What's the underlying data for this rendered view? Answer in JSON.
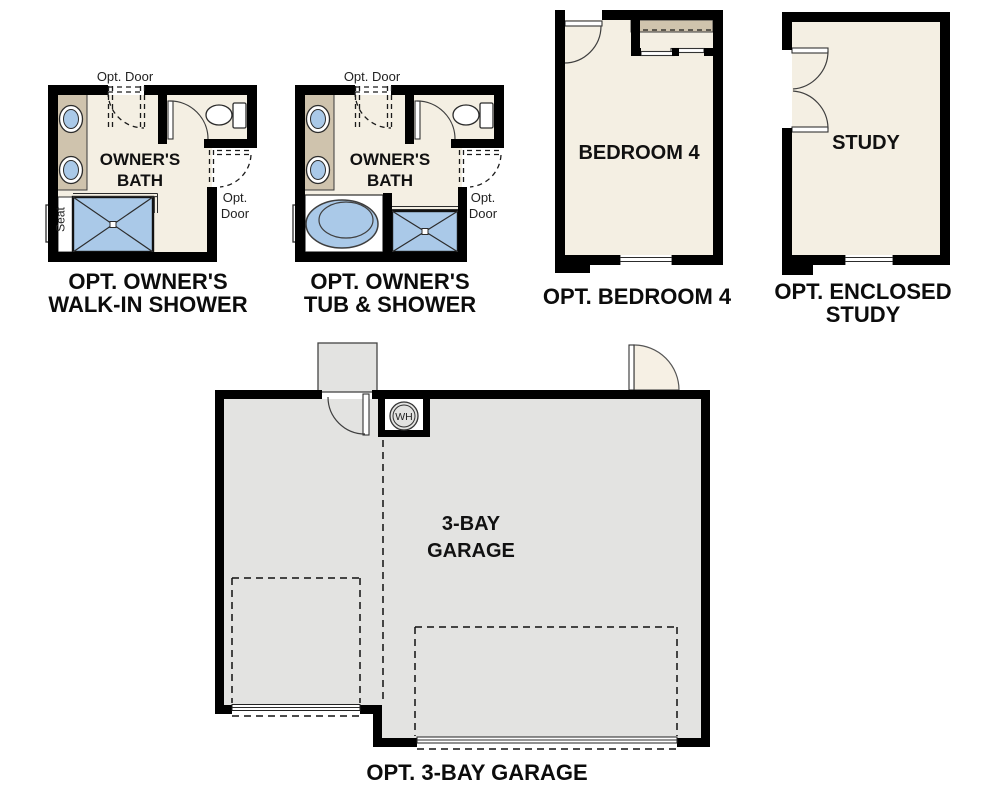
{
  "page": {
    "background": "#ffffff"
  },
  "colors": {
    "wall": "#000000",
    "floor_cream": "#f4efe3",
    "counter_tan": "#cfc3ad",
    "fixture_blue": "#aac9e8",
    "garage_gray": "#e3e3e1",
    "door_swing_cream": "#f6f0e4",
    "text": "#111111"
  },
  "plans": {
    "walk_in_shower": {
      "caption_line1": "OPT. OWNER'S",
      "caption_line2": "WALK-IN SHOWER",
      "room_line1": "OWNER'S",
      "room_line2": "BATH",
      "opt_door_top": "Opt. Door",
      "opt_door_right_line1": "Opt.",
      "opt_door_right_line2": "Door",
      "seat_label": "Seat"
    },
    "tub_shower": {
      "caption_line1": "OPT. OWNER'S",
      "caption_line2": "TUB & SHOWER",
      "room_line1": "OWNER'S",
      "room_line2": "BATH",
      "opt_door_top": "Opt. Door",
      "opt_door_right_line1": "Opt.",
      "opt_door_right_line2": "Door"
    },
    "bedroom4": {
      "caption": "OPT. BEDROOM 4",
      "room_label": "BEDROOM 4"
    },
    "study": {
      "caption_line1": "OPT. ENCLOSED",
      "caption_line2": "STUDY",
      "room_label": "STUDY"
    },
    "garage": {
      "caption": "OPT. 3-BAY GARAGE",
      "room_line1": "3-BAY",
      "room_line2": "GARAGE",
      "water_heater_label": "WH"
    }
  }
}
